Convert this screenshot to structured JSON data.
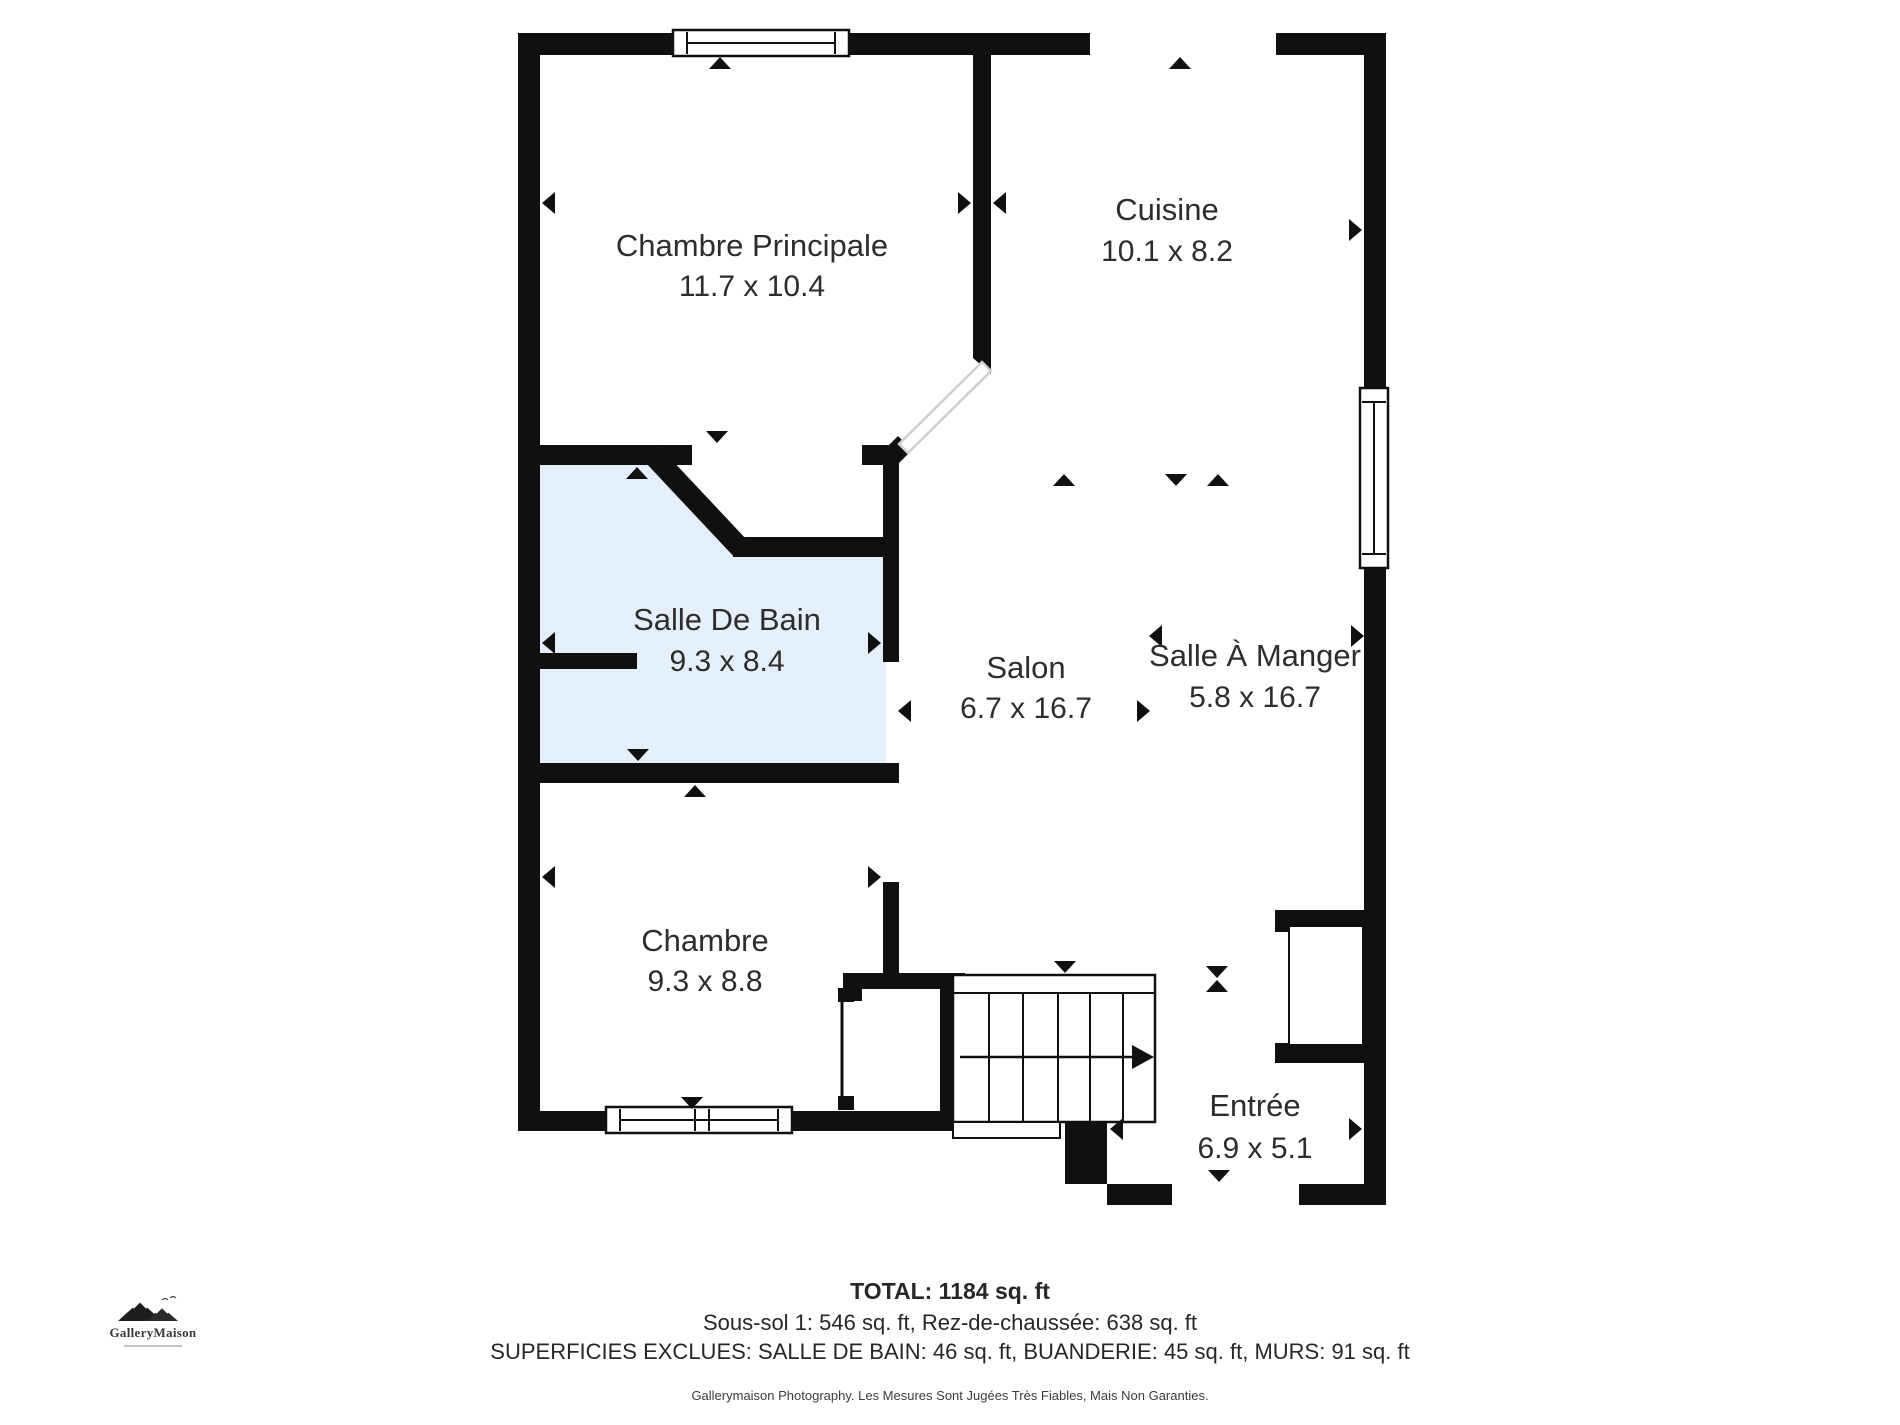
{
  "colors": {
    "wall": "#101010",
    "bath_fill": "#e4effb",
    "text": "#2d2d2d",
    "thin_line": "#101010",
    "corridor_line": "#cfcfcf"
  },
  "rooms": [
    {
      "id": "chambre-principale",
      "name": "Chambre Principale",
      "dims": "11.7 x 10.4",
      "x": 752,
      "name_y": 248,
      "dims_y": 288
    },
    {
      "id": "cuisine",
      "name": "Cuisine",
      "dims": "10.1 x 8.2",
      "x": 1167,
      "name_y": 212,
      "dims_y": 253
    },
    {
      "id": "salle-de-bain",
      "name": "Salle De Bain",
      "dims": "9.3 x 8.4",
      "x": 727,
      "name_y": 622,
      "dims_y": 663
    },
    {
      "id": "salon",
      "name": "Salon",
      "dims": "6.7 x 16.7",
      "x": 1026,
      "name_y": 670,
      "dims_y": 710
    },
    {
      "id": "salle-a-manger",
      "name": "Salle À Manger",
      "dims": "5.8 x 16.7",
      "x": 1255,
      "name_y": 658,
      "dims_y": 699
    },
    {
      "id": "chambre",
      "name": "Chambre",
      "dims": "9.3 x 8.8",
      "x": 705,
      "name_y": 943,
      "dims_y": 983
    },
    {
      "id": "entree",
      "name": "Entrée",
      "dims": "6.9 x 5.1",
      "x": 1255,
      "name_y": 1108,
      "dims_y": 1150
    }
  ],
  "summary": {
    "total": "TOTAL: 1184 sq. ft",
    "levels": "Sous-sol 1: 546 sq. ft, Rez-de-chaussée: 638 sq. ft",
    "excluded": "SUPERFICIES EXCLUES: SALLE DE BAIN: 46 sq. ft, BUANDERIE: 45 sq. ft, MURS: 91 sq. ft"
  },
  "footer_caption": "Gallerymaison Photography. Les Mesures Sont Jugées Très Fiables, Mais Non Garanties.",
  "logo": {
    "name": "GalleryMaison"
  },
  "plan": {
    "bath_polygon": "538,465 652,465 740,557 886,557 886,763 538,763",
    "walls": [
      {
        "name": "top-wall-left",
        "x": 518,
        "y": 33,
        "w": 157,
        "h": 22
      },
      {
        "name": "top-wall-mid",
        "x": 847,
        "y": 33,
        "w": 243,
        "h": 22
      },
      {
        "name": "top-wall-right",
        "x": 1276,
        "y": 33,
        "w": 110,
        "h": 22
      },
      {
        "name": "left-wall",
        "x": 518,
        "y": 33,
        "w": 22,
        "h": 1098
      },
      {
        "name": "right-wall",
        "x": 1364,
        "y": 33,
        "w": 22,
        "h": 1172
      },
      {
        "name": "divider-chambre-cuisine",
        "x": 973,
        "y": 52,
        "w": 18,
        "h": 303
      },
      {
        "name": "chambre-principale-bottom-left",
        "x": 518,
        "y": 445,
        "w": 174,
        "h": 20
      },
      {
        "name": "chambre-principale-bottom-right",
        "x": 862,
        "y": 445,
        "w": 33,
        "h": 20
      },
      {
        "name": "closet-pocket-bottom-wall",
        "x": 733,
        "y": 537,
        "w": 152,
        "h": 20
      },
      {
        "name": "bathroom-right-wall",
        "x": 883,
        "y": 445,
        "w": 16,
        "h": 217
      },
      {
        "name": "bathroom-bottom-wall",
        "x": 518,
        "y": 763,
        "w": 381,
        "h": 20
      },
      {
        "name": "bathroom-left-stub-wall",
        "x": 538,
        "y": 653,
        "w": 99,
        "h": 16
      },
      {
        "name": "chambre-right-wall",
        "x": 883,
        "y": 882,
        "w": 16,
        "h": 91
      },
      {
        "name": "chambre-closet-top-wall",
        "x": 843,
        "y": 973,
        "w": 122,
        "h": 16
      },
      {
        "name": "chambre-closet-left-block",
        "x": 843,
        "y": 973,
        "w": 19,
        "h": 28
      },
      {
        "name": "stairs-left-wall",
        "x": 940,
        "y": 973,
        "w": 25,
        "h": 158
      },
      {
        "name": "chambre-bottom-wall",
        "x": 518,
        "y": 1111,
        "w": 437,
        "h": 20
      },
      {
        "name": "bottom-corner-block",
        "x": 1065,
        "y": 1122,
        "w": 42,
        "h": 62
      },
      {
        "name": "entree-bottom-wall-left",
        "x": 1107,
        "y": 1184,
        "w": 65,
        "h": 21
      },
      {
        "name": "entree-bottom-wall-right",
        "x": 1299,
        "y": 1184,
        "w": 87,
        "h": 21
      },
      {
        "name": "sam-closet-top-wall",
        "x": 1275,
        "y": 910,
        "w": 111,
        "h": 22
      },
      {
        "name": "sam-closet-bottom-wall",
        "x": 1275,
        "y": 1043,
        "w": 111,
        "h": 20
      }
    ],
    "diag_wall": {
      "name": "bathroom-diagonal-wall",
      "x1": 650,
      "y1": 452,
      "x2": 742,
      "y2": 550,
      "width": 21
    },
    "corridor": {
      "name": "diagonal-door-corridor",
      "band": "982,362 991,371 908,453 899,444",
      "cap_top": "973,351 991,351 991,374 973,358",
      "cap_bottom": "898,436 912,450 898,464 884,450"
    },
    "windows": [
      {
        "name": "window-top",
        "x": 673,
        "y": 30,
        "w": 176,
        "h": 26,
        "orient": "h",
        "mullions": []
      },
      {
        "name": "window-right",
        "x": 1360,
        "y": 388,
        "w": 28,
        "h": 180,
        "orient": "v",
        "mullions": []
      },
      {
        "name": "window-bottom",
        "x": 606,
        "y": 1107,
        "w": 186,
        "h": 26,
        "orient": "h",
        "mullions": [
          695,
          709
        ]
      }
    ],
    "stairs": {
      "name": "staircase",
      "x": 953,
      "y": 975,
      "w": 202,
      "h": 147,
      "top_line_y": 993,
      "treads": [
        989,
        1023,
        1058,
        1090,
        1123
      ],
      "landing": {
        "x": 953,
        "y": 1122,
        "w": 107,
        "h": 16
      },
      "arrow": {
        "x1": 960,
        "y": 1057,
        "x2": 1132,
        "tip": 1154
      }
    },
    "chambre_closet_leaf": {
      "name": "chambre-closet-door-leaf",
      "line_x": 842,
      "y1": 1002,
      "y2": 1098,
      "nubs": [
        {
          "x": 838,
          "y": 988,
          "w": 16,
          "h": 14
        },
        {
          "x": 838,
          "y": 1096,
          "w": 16,
          "h": 14
        }
      ]
    },
    "sam_closet_leaf": {
      "name": "sam-closet-door-leaf",
      "x": 1289,
      "y": 926,
      "w": 74,
      "h": 119
    },
    "markers": [
      {
        "name": "door-marker",
        "x": 720,
        "y": 57,
        "d": "up"
      },
      {
        "name": "door-marker",
        "x": 1180,
        "y": 57,
        "d": "up"
      },
      {
        "name": "dim-marker",
        "x": 542,
        "y": 203,
        "d": "left"
      },
      {
        "name": "dim-marker",
        "x": 971,
        "y": 203,
        "d": "right"
      },
      {
        "name": "dim-marker",
        "x": 993,
        "y": 203,
        "d": "left"
      },
      {
        "name": "dim-marker",
        "x": 1362,
        "y": 230,
        "d": "right"
      },
      {
        "name": "dim-marker",
        "x": 1064,
        "y": 474,
        "d": "up"
      },
      {
        "name": "dim-marker",
        "x": 1176,
        "y": 486,
        "d": "down"
      },
      {
        "name": "dim-marker",
        "x": 1218,
        "y": 474,
        "d": "up"
      },
      {
        "name": "door-marker",
        "x": 717,
        "y": 443,
        "d": "down"
      },
      {
        "name": "door-marker",
        "x": 637,
        "y": 467,
        "d": "up"
      },
      {
        "name": "dim-marker",
        "x": 542,
        "y": 643,
        "d": "left"
      },
      {
        "name": "dim-marker",
        "x": 881,
        "y": 643,
        "d": "right"
      },
      {
        "name": "door-marker",
        "x": 638,
        "y": 761,
        "d": "down"
      },
      {
        "name": "door-marker",
        "x": 695,
        "y": 785,
        "d": "up"
      },
      {
        "name": "dim-marker",
        "x": 542,
        "y": 877,
        "d": "left"
      },
      {
        "name": "dim-marker",
        "x": 881,
        "y": 877,
        "d": "right"
      },
      {
        "name": "door-marker",
        "x": 692,
        "y": 1109,
        "d": "down"
      },
      {
        "name": "dim-marker",
        "x": 898,
        "y": 711,
        "d": "left"
      },
      {
        "name": "dim-marker",
        "x": 1150,
        "y": 711,
        "d": "right"
      },
      {
        "name": "dim-marker",
        "x": 1149,
        "y": 636,
        "d": "left"
      },
      {
        "name": "dim-marker",
        "x": 1364,
        "y": 636,
        "d": "right"
      },
      {
        "name": "door-marker",
        "x": 1065,
        "y": 973,
        "d": "down"
      },
      {
        "name": "height-marker",
        "x": 1217,
        "y": 978,
        "d": "down"
      },
      {
        "name": "height-marker",
        "x": 1217,
        "y": 980,
        "d": "up"
      },
      {
        "name": "dim-marker",
        "x": 1110,
        "y": 1129,
        "d": "left"
      },
      {
        "name": "dim-marker",
        "x": 1362,
        "y": 1129,
        "d": "right"
      },
      {
        "name": "door-marker",
        "x": 1219,
        "y": 1182,
        "d": "down"
      }
    ]
  }
}
